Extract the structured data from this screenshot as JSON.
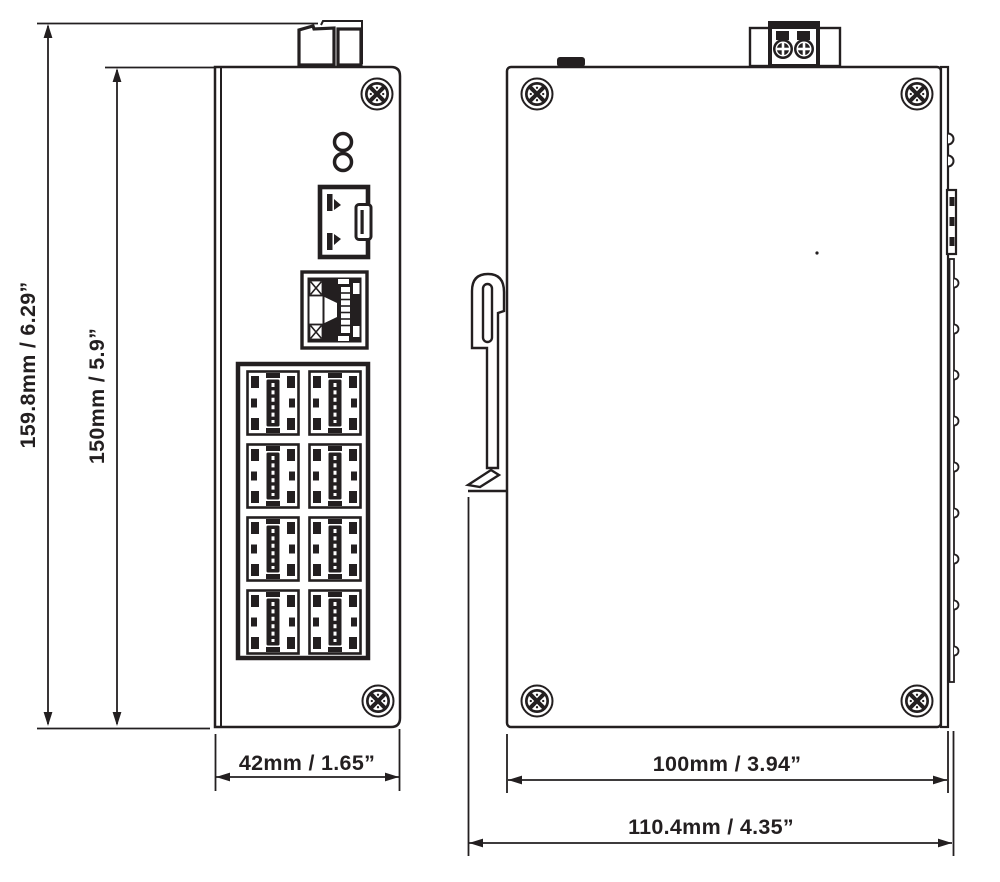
{
  "page": {
    "background_color": "#ffffff",
    "line_color": "#231f20"
  },
  "views": {
    "front": {
      "name": "front-view",
      "labels": {
        "height_overall": "159.8mm / 6.29”",
        "height_body": "150mm / 5.9”",
        "width": "42mm / 1.65”"
      },
      "features": {
        "led_count": 2,
        "sfp_port_count": 1,
        "single_rj45_port_count": 1,
        "rj45_grid_port_count": 8,
        "screw_count": 2,
        "din_clip_tab": true
      }
    },
    "side": {
      "name": "side-view",
      "labels": {
        "depth_body": "100mm / 3.94”",
        "depth_overall": "110.4mm / 4.35”"
      },
      "features": {
        "corner_screw_count": 4,
        "terminal_screw_count": 2,
        "din_rail_clip": true,
        "side_port_bump_count": 9
      }
    }
  },
  "icons": {
    "phillips_screw": "circled X screw head",
    "terminal_screw": "filled circle with cross",
    "led_indicator": "small circle",
    "dimension_arrow": "slender triangle"
  }
}
